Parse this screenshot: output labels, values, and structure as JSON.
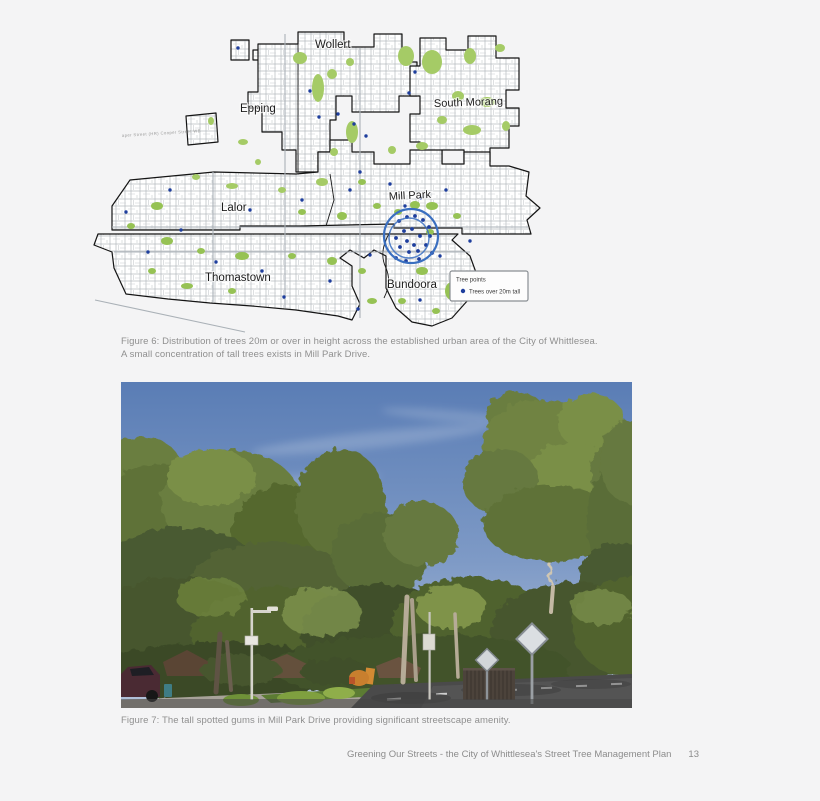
{
  "map": {
    "labels": {
      "wollert": "Wollert",
      "epping": "Epping",
      "south_morang": "South Morang",
      "mill_park": "Mill Park",
      "lalor": "Lalor",
      "thomastown": "Thomastown",
      "bundoora": "Bundoora"
    },
    "tiny_street_label": "aper Street (HR) Cooper Street WB",
    "legend": {
      "title": "Tree points",
      "item_label": "Trees over 20m tall"
    },
    "colors": {
      "park_green": "#a5cb66",
      "tree_point_blue": "#1e3e9d",
      "highlight_circle_blue": "#3a6fc0"
    }
  },
  "captions": {
    "figure6_line1": "Figure 6: Distribution of trees 20m or over in height across the established urban area of the City of Whittlesea.",
    "figure6_line2": "A small concentration of tall trees exists in Mill Park Drive.",
    "figure7": "Figure 7: The tall spotted gums in Mill Park Drive providing significant streetscape amenity."
  },
  "footer": {
    "text": "Greening Our Streets - the City of Whittlesea's Street Tree Management Plan",
    "page_number": "13"
  }
}
